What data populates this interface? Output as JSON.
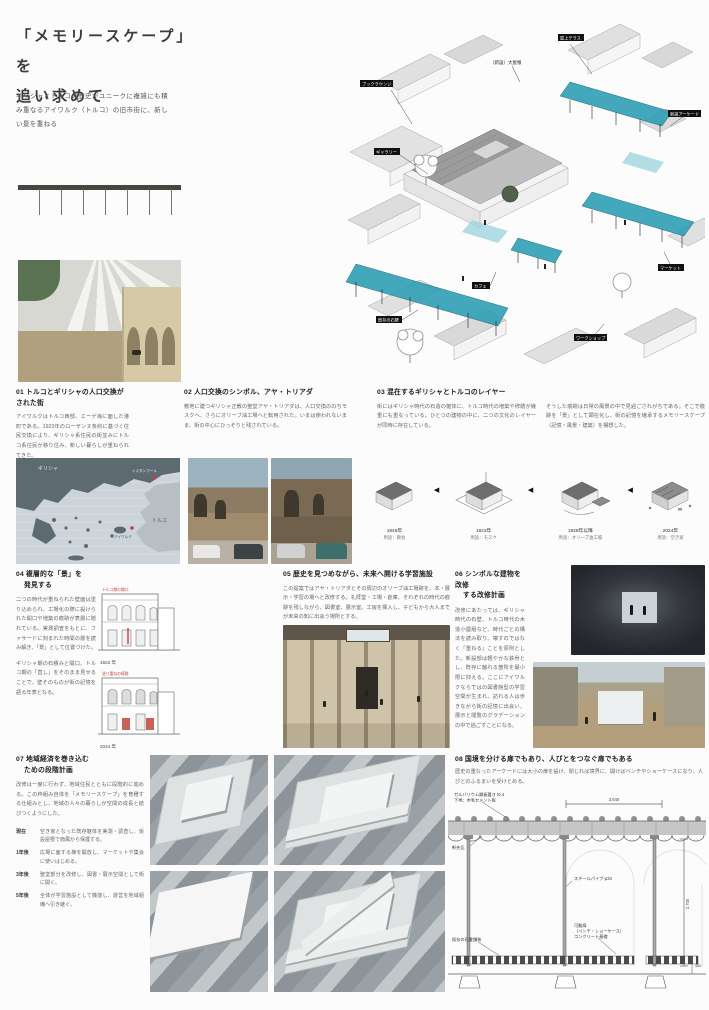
{
  "meta": {
    "accent_teal": "#2f9fb4",
    "accent_red": "#c0443c",
    "paper": "#fcfcfc"
  },
  "header": {
    "title_line1": "「メモリースケープ」を",
    "title_line2": "追い求めて",
    "lead": "ギリシャとトルコの歴史がユニークに複雑にも積み重なるアイワルク（トルコ）の旧市街に、新しい景を重ねる"
  },
  "axon": {
    "note": "（新設）大屋根",
    "labels": [
      "屋上テラス",
      "ブックラウンジ",
      "ギャラリー",
      "カフェ",
      "ワークショップ",
      "マーケット",
      "新設アーケード",
      "既存の石壁"
    ]
  },
  "map": {
    "greece": "ギリシャ",
    "turkey": "トルコ",
    "istanbul": "イスタンブール",
    "ayvalik": "アイワルク"
  },
  "timeline": {
    "arrow": "◀",
    "items": [
      {
        "year": "1846年",
        "use": "用途：教会"
      },
      {
        "year": "1923年",
        "use": "用途：モスク"
      },
      {
        "year": "1928年以降",
        "use": "用途：オリーブ油工場"
      },
      {
        "year": "2024年",
        "use": "用途：空き家"
      }
    ]
  },
  "sections": {
    "s01": {
      "heading": "01 トルコとギリシャの人口交換がされた街",
      "body": "アイワルクはトルコ西部、エーゲ海に面した港町である。1923年のローザンヌ条約に基づく住民交換により、ギリシャ系住民の街並みにトルコ系住民が移り住み、新しい暮らしが重ねられてきた。"
    },
    "s02": {
      "heading": "02 人口交換のシンボル、アヤ・トリアダ",
      "body": "敷地に建つギリシャ正教の聖堂アヤ・トリアダは、人口交換ののちモスクへ、さらにオリーブ油工場へと転用された。いまは使われないまま、街の中心にひっそりと残されている。"
    },
    "s03": {
      "heading": "03 混在するギリシャとトルコのレイヤー",
      "body_left": "街にはギリシャ時代の石造の躯体に、トルコ時代の増築や修繕が幾重にも重なっている。ひとつの建物の中に、二つの文化のレイヤーが同時に存在している。",
      "body_right": "そうした痕跡は日常の風景の中で見過ごされがちである。そこで痕跡を「景」として顕在化し、街の記憶を継承するメモリースケープ（記憶・風景・建築）を構想した。"
    },
    "s04": {
      "heading_line1": "04 複層的な「景」を",
      "heading_line2": "発見する",
      "body1": "二つの時代が重ねられた壁面は塗り込められ、工場化の際に設けられた開口や増築の痕跡が表層に隠れている。実測調査をもとに、ファサードに刻まれた時間の層を読み解き、「景」として位置づけた。",
      "body2": "ギリシャ期の石積みと開口、トルコ期の「直し」をそのまま見せることで、壁そのものが街の記憶を語る年表となる。",
      "note1": "トルコ期の開口",
      "note2": "塗り重ねの痕跡",
      "cap1": "1922 年",
      "cap2": "2024 年"
    },
    "s05": {
      "heading": "05 歴史を見つめながら、未来へ開ける学習施設",
      "body": "この提案ではアヤ・トリアダとその周辺のオリーブ油工場跡を、本・展示・学習の場へと改修する。礼拝堂・工場・倉庫、それぞれの時代の痕跡を残しながら、図書室、展示室、工房を挿入し、子どもから大人までが未来の知に出会う場所とする。"
    },
    "s06": {
      "heading_line1": "06 シンボルな建物を改修",
      "heading_line2": "する改修計画",
      "body": "改修にあたっては、ギリシャ時代の石壁、トルコ時代の木造小屋組など、時代ごとの構法を読み取り、壊すのではなく「重ねる」ことを原則とした。新設部は軽やかな鉄骨とし、既存に触れる箇所を最小限に抑える。ここにアイワルクならではの図書館型の学習空間が生まれ、訪れる人は歩きながら街の記憶に出会い、展示と閲覧のグラデーションの中で過ごすことになる。"
    },
    "s07": {
      "heading_line1": "07 地域経済を巻き込む",
      "heading_line2": "ための段階計画",
      "body": "改修は一度に行わず、地域住民とともに段階的に進める。この枠組み自体を「メモリースケープ」を育種する仕組みとし、地域の人々の暮らしが空間の成長と結びつくようにした。",
      "items": [
        {
          "label": "現在",
          "text": "空き家となった既存躯体を実測・調査し、仮設屋根で雨風から保護する。"
        },
        {
          "label": "1年後",
          "text": "広場に面する棟を開放し、マーケットや集会に使いはじめる。"
        },
        {
          "label": "3年後",
          "text": "聖堂部分を改修し、図書・展示空間として街に開く。"
        },
        {
          "label": "5年後",
          "text": "全体が学習施設として機能し、運営を地域組織へ引き継ぐ。"
        }
      ]
    },
    "s08": {
      "heading": "08 国境を分ける扉でもあり、人びとをつなぐ扉でもある",
      "sub": "歴史の重なったアーケードには大小の扉を設け、閉じれば境界に、開けばベンチやショーケースになり、人びとのふるまいを受けとめる。"
    }
  },
  "detail": {
    "labels": {
      "roof1": "ガルバリウム鋼板葺き t0.4",
      "roof2": "下地：木毛セメント板",
      "tile": "軒先瓦",
      "pipe": "スチールパイプ φ34",
      "door1": "可動扉",
      "door2": "（ベンチ・ショーケース）",
      "footing": "コンクリート基礎",
      "paving": "既存の石畳舗装",
      "dim_w": "3,640",
      "dim_h": "2,700",
      "dim_f": "450"
    }
  }
}
